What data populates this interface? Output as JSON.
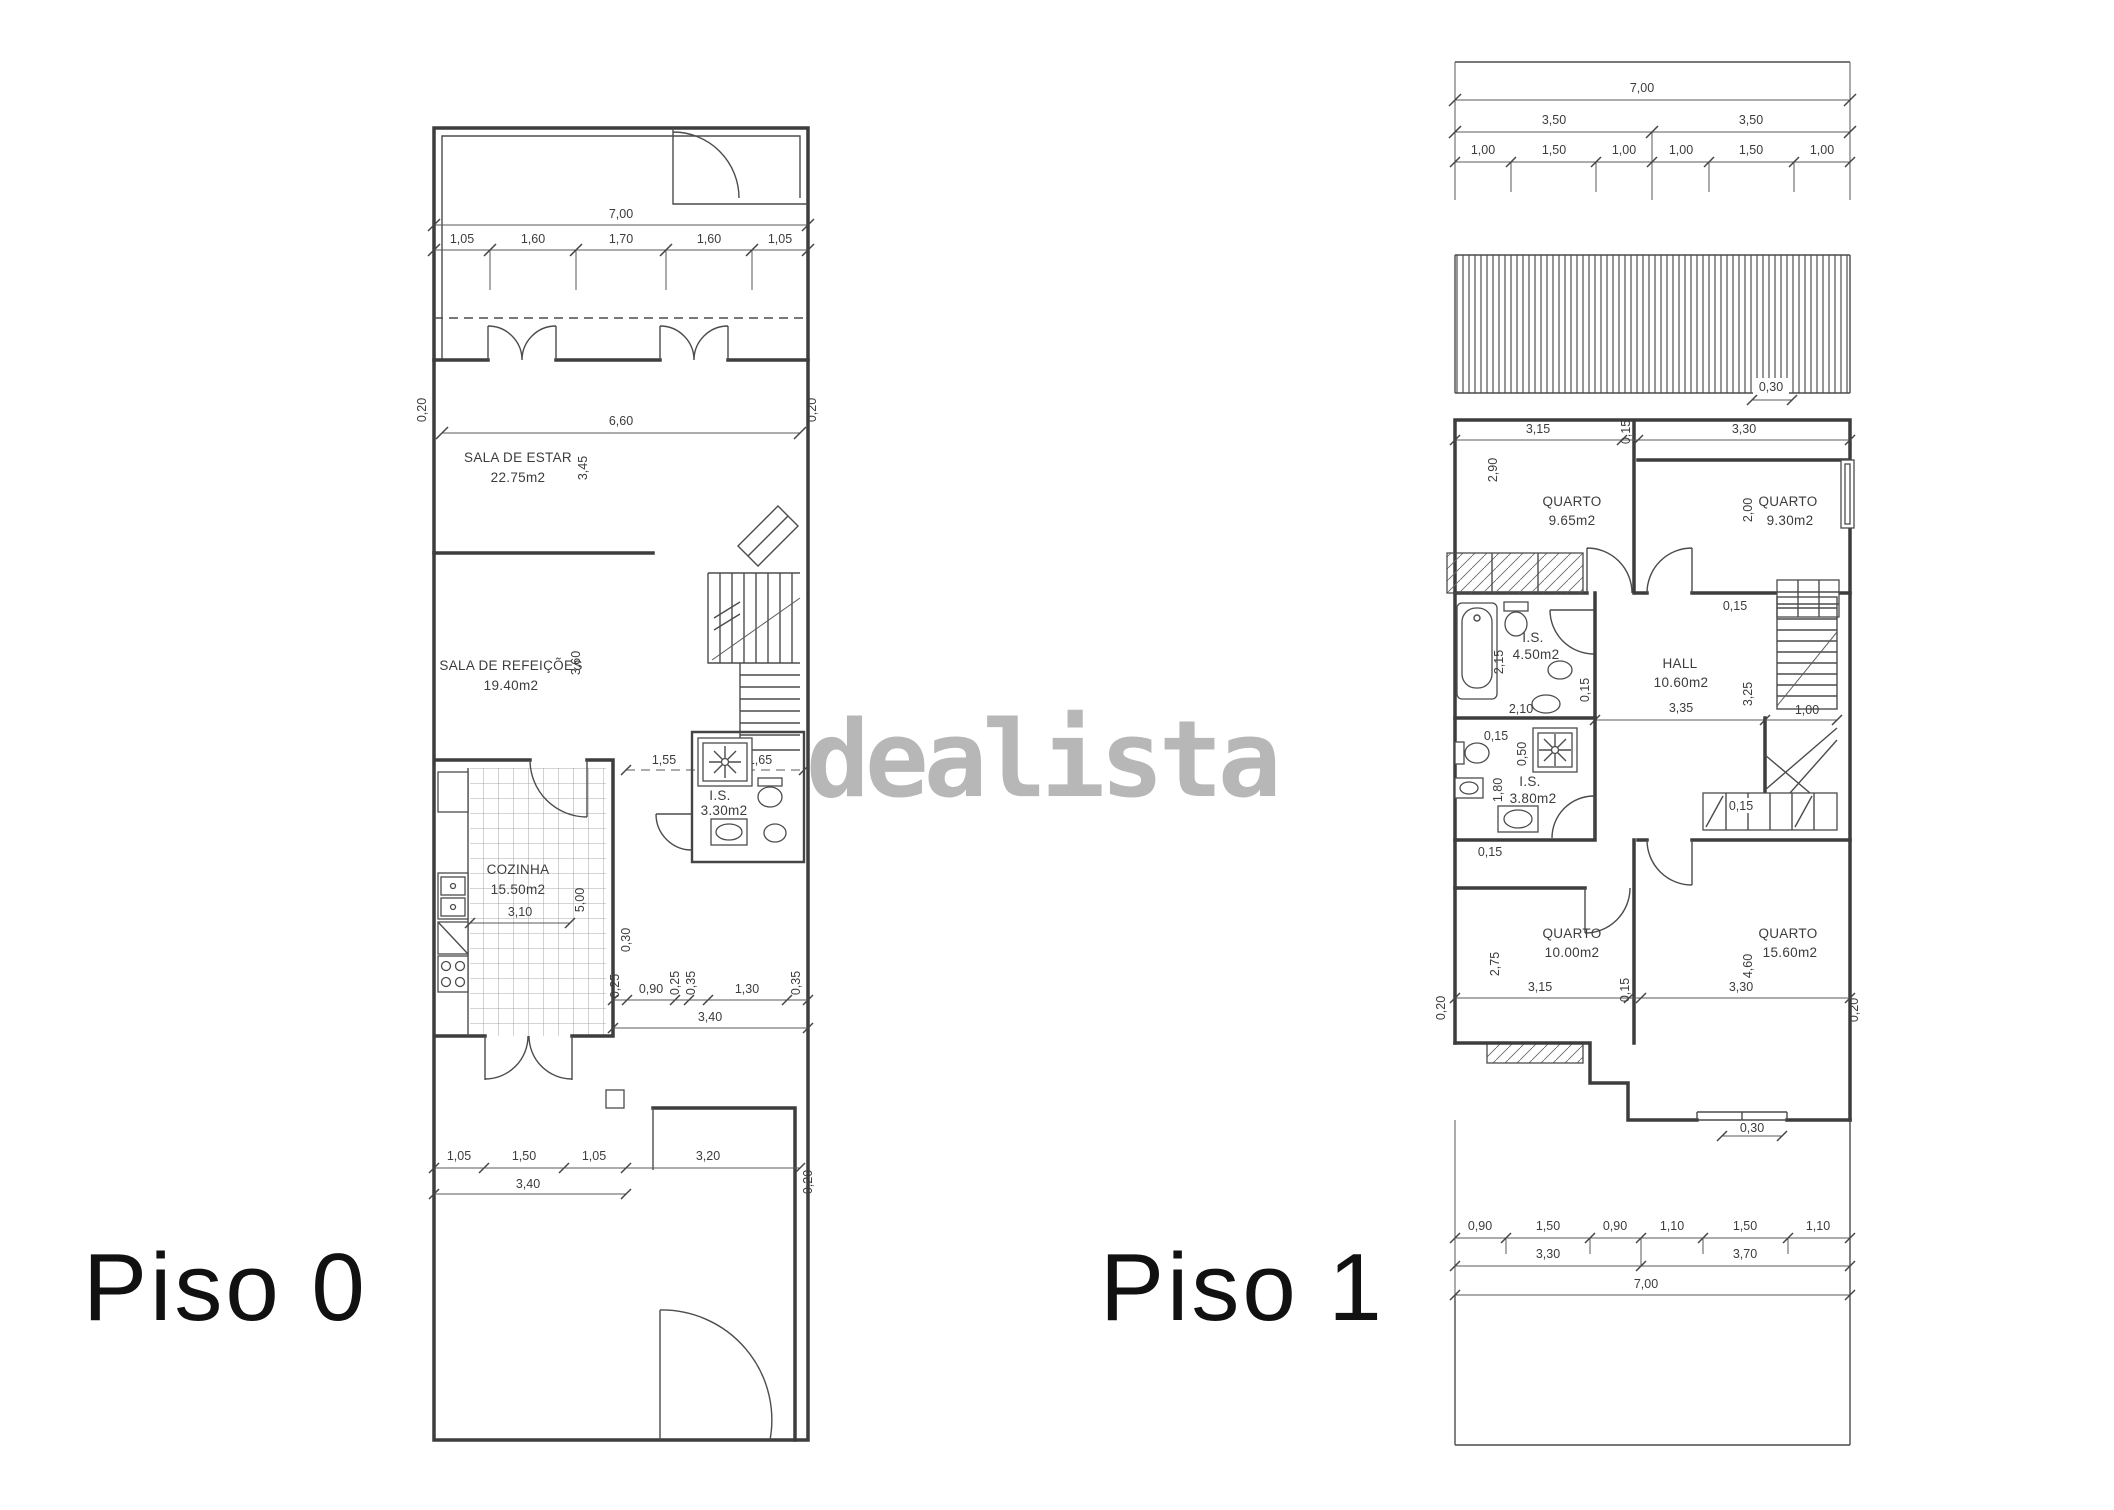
{
  "watermark": {
    "text": "dealista",
    "color": "#b7b7b7"
  },
  "piso0": {
    "label": "Piso 0",
    "rooms": {
      "estar": {
        "name": "SALA DE ESTAR",
        "area": "22.75m2"
      },
      "refeicoes": {
        "name": "SALA DE REFEIÇÕES",
        "area": "19.40m2"
      },
      "cozinha": {
        "name": "COZINHA",
        "area": "15.50m2"
      },
      "is": {
        "name": "I.S.",
        "area": "3.30m2"
      }
    },
    "dims": {
      "total_width": "7,00",
      "top_segments": [
        "1,05",
        "1,60",
        "1,70",
        "1,60",
        "1,05"
      ],
      "wall_left": "0,20",
      "wall_right": "0,20",
      "estar_w": "6,60",
      "estar_h": "3,45",
      "refeicoes_h": "3,60",
      "door_155": "1,55",
      "door_015": "0,15",
      "is_w": "1,65",
      "cozinha_w": "3,10",
      "cozinha_h": "5,00",
      "wall_030": "0,30",
      "mid_025a": "0,25",
      "mid_090": "0,90",
      "mid_025b": "0,25",
      "mid_035a": "0,35",
      "mid_130": "1,30",
      "mid_035b": "0,35",
      "mid_340": "3,40",
      "yard_105a": "1,05",
      "yard_150": "1,50",
      "yard_105b": "1,05",
      "yard_340": "3,40",
      "yard_320": "3,20",
      "yard_020": "0,20"
    }
  },
  "piso1": {
    "label": "Piso 1",
    "rooms": {
      "quarto1": {
        "name": "QUARTO",
        "area": "9.65m2"
      },
      "quarto2": {
        "name": "QUARTO",
        "area": "9.30m2"
      },
      "is1": {
        "name": "I.S.",
        "area": "4.50m2"
      },
      "hall": {
        "name": "HALL",
        "area": "10.60m2"
      },
      "is2": {
        "name": "I.S.",
        "area": "3.80m2"
      },
      "quarto3": {
        "name": "QUARTO",
        "area": "10.00m2"
      },
      "quarto4": {
        "name": "QUARTO",
        "area": "15.60m2"
      }
    },
    "dims": {
      "total_width_top": "7,00",
      "half_left": "3,50",
      "half_right": "3,50",
      "top_segments": [
        "1,00",
        "1,50",
        "1,00",
        "1,00",
        "1,50",
        "1,00"
      ],
      "roof_030": "0,30",
      "q1_w": "3,15",
      "q1_h": "2,90",
      "wall_015_top": "0,15",
      "q2_w": "3,30",
      "q2_h": "2,00",
      "is1_h1": "2,15",
      "is1_h2": "2,10",
      "is1_wall": "0,15",
      "hall_w": "3,35",
      "hall_h": "3,25",
      "hall_015": "0,15",
      "stairs_100": "1,00",
      "is2_015a": "0,15",
      "is2_050": "0,50",
      "is2_h": "1,80",
      "is2_015b": "0,15",
      "ward_015": "0,15",
      "q3_w": "3,15",
      "q3_h": "2,75",
      "wall_015_bot": "0,15",
      "q4_w": "3,30",
      "q4_h": "4,60",
      "edge_020_l": "0,20",
      "edge_020_r": "0,20",
      "balcony_030": "0,30",
      "bottom_segments": [
        "0,90",
        "1,50",
        "0,90",
        "1,10",
        "1,50",
        "1,10"
      ],
      "bottom_330": "3,30",
      "bottom_370": "3,70",
      "total_width_bottom": "7,00"
    }
  }
}
